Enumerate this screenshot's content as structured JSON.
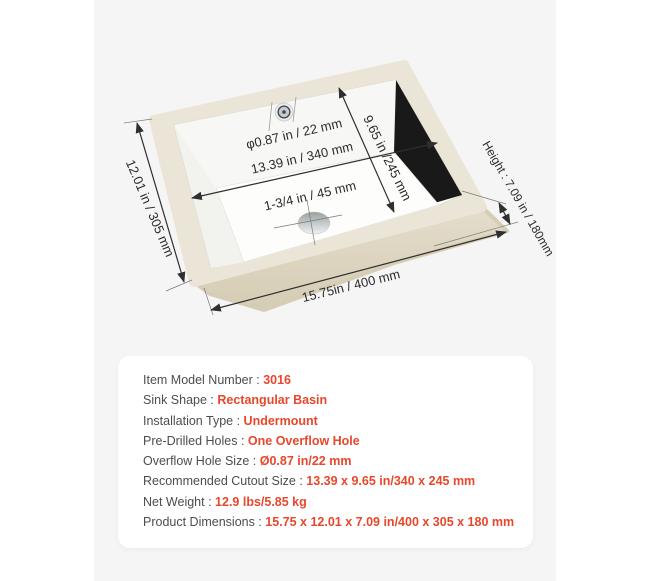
{
  "colors": {
    "accent": "#e8472b",
    "label_text": "#4d4d4d",
    "panel_background": "#f5f5f6",
    "card_background": "#ffffff",
    "diagram_ink": "#2b2b2b",
    "sink_rim": "#eae5d7"
  },
  "diagram": {
    "labels": {
      "outer_width": "12.01 in / 305 mm",
      "outer_length": "15.75in / 400 mm",
      "height": "Height : 7.09 in / 180mm",
      "basin_length": "13.39 in / 340 mm",
      "basin_width": "9.65 in /245 mm",
      "overflow": "φ0.87 in / 22 mm",
      "drain": "1-3/4 in / 45 mm"
    }
  },
  "spec_card": {
    "rows": [
      {
        "label": "Item Model Number :",
        "value": "3016"
      },
      {
        "label": "Sink Shape :",
        "value": "Rectangular Basin"
      },
      {
        "label": "Installation Type :",
        "value": "Undermount"
      },
      {
        "label": "Pre-Drilled Holes :",
        "value": "One Overflow Hole"
      },
      {
        "label": "Overflow Hole Size :",
        "value": "Ø0.87 in/22 mm"
      },
      {
        "label": "Recommended Cutout Size :",
        "value": "13.39 x 9.65 in/340 x 245 mm"
      },
      {
        "label": "Net Weight :",
        "value": "12.9 lbs/5.85 kg"
      },
      {
        "label": "Product Dimensions :",
        "value": "15.75 x 12.01 x 7.09 in/400 x 305 x 180 mm"
      }
    ]
  }
}
